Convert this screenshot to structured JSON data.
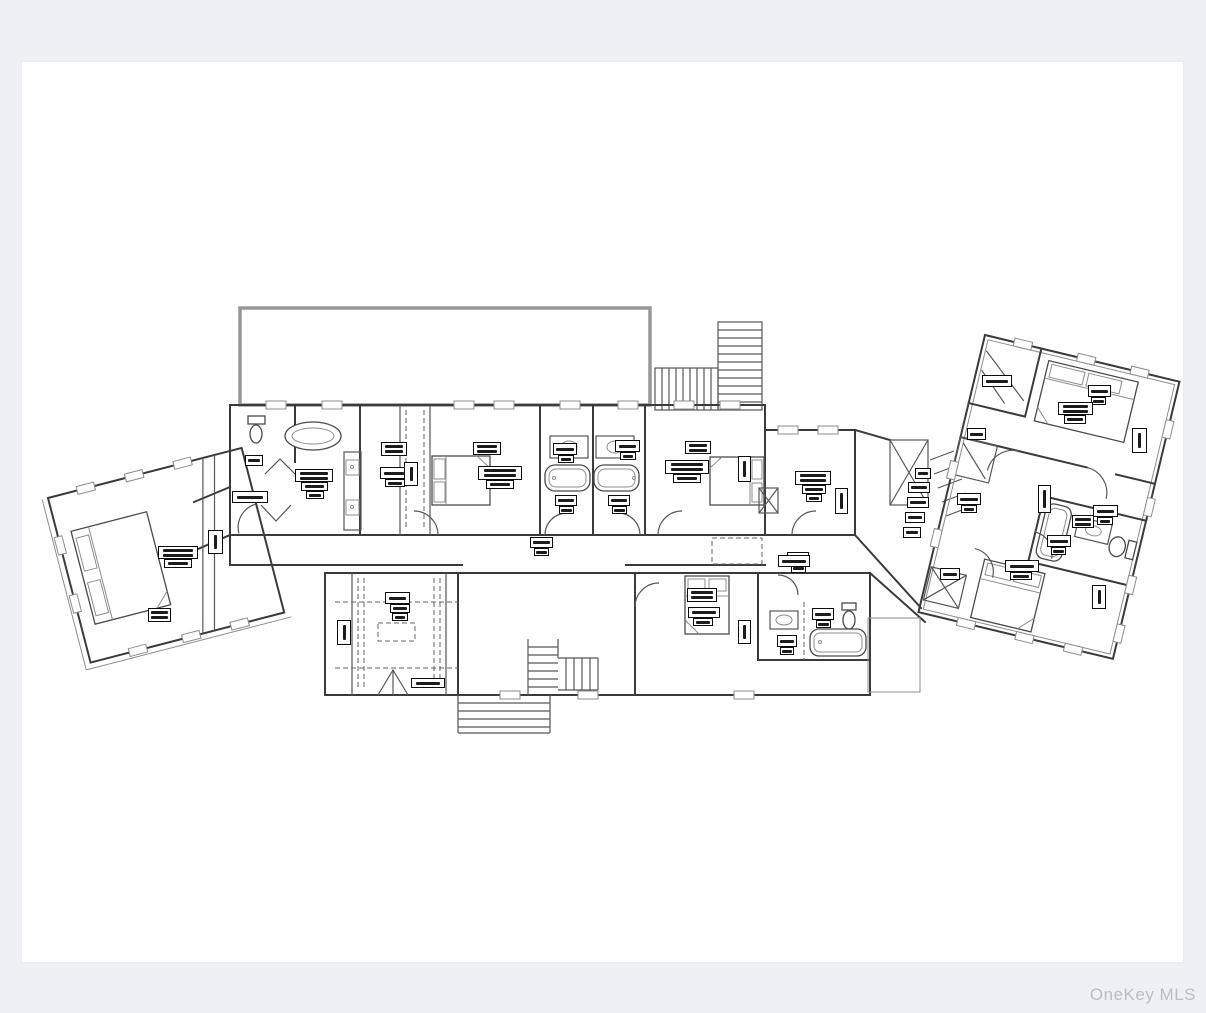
{
  "page": {
    "background_color": "#eff0f5",
    "panel_color": "#ffffff"
  },
  "watermark": {
    "text": "OneKey MLS",
    "color": "#b9bdc5"
  },
  "floorplan": {
    "type": "architectural-floor-plan",
    "content_note": "Black-and-white residential floor plan line drawing on a white sheet: a long central body with bathrooms and bedrooms, an angled bedroom wing on the left, an angled multi-room wing on the right, a large deck outline at top, interior and exterior staircases, beds, tubs, toilets and vanities drawn in plan view.",
    "label_legibility": "Room name and dimension labels are present as small boxed annotations but are illegible at source resolution",
    "labels": [
      [
        223,
        393,
        18,
        11
      ],
      [
        210,
        429,
        36,
        12
      ],
      [
        273,
        407,
        38,
        13
      ],
      [
        279,
        420,
        27,
        9
      ],
      [
        284,
        429,
        18,
        8
      ],
      [
        359,
        380,
        26,
        14
      ],
      [
        358,
        405,
        28,
        12
      ],
      [
        363,
        417,
        20,
        8
      ],
      [
        382,
        400,
        14,
        24
      ],
      [
        451,
        380,
        28,
        13
      ],
      [
        456,
        404,
        44,
        14
      ],
      [
        464,
        418,
        28,
        9
      ],
      [
        531,
        381,
        24,
        12
      ],
      [
        536,
        393,
        16,
        8
      ],
      [
        593,
        378,
        25,
        12
      ],
      [
        598,
        390,
        16,
        8
      ],
      [
        533,
        433,
        22,
        11
      ],
      [
        537,
        444,
        15,
        8
      ],
      [
        586,
        433,
        22,
        11
      ],
      [
        590,
        444,
        15,
        8
      ],
      [
        508,
        475,
        23,
        11
      ],
      [
        512,
        486,
        15,
        8
      ],
      [
        663,
        379,
        26,
        13
      ],
      [
        643,
        398,
        44,
        14
      ],
      [
        651,
        412,
        28,
        9
      ],
      [
        716,
        394,
        13,
        26
      ],
      [
        773,
        409,
        36,
        14
      ],
      [
        780,
        423,
        24,
        9
      ],
      [
        784,
        432,
        16,
        8
      ],
      [
        813,
        426,
        13,
        26
      ],
      [
        893,
        406,
        16,
        11
      ],
      [
        886,
        420,
        22,
        11
      ],
      [
        885,
        435,
        22,
        11
      ],
      [
        883,
        450,
        20,
        11
      ],
      [
        881,
        465,
        18,
        11
      ],
      [
        765,
        490,
        22,
        12
      ],
      [
        769,
        502,
        15,
        9
      ],
      [
        363,
        530,
        25,
        12
      ],
      [
        368,
        542,
        20,
        9
      ],
      [
        370,
        551,
        16,
        8
      ],
      [
        315,
        558,
        14,
        25
      ],
      [
        389,
        616,
        34,
        10
      ],
      [
        665,
        526,
        30,
        14
      ],
      [
        666,
        545,
        32,
        11
      ],
      [
        671,
        556,
        20,
        8
      ],
      [
        716,
        558,
        13,
        24
      ],
      [
        756,
        493,
        32,
        12
      ],
      [
        790,
        546,
        22,
        12
      ],
      [
        794,
        558,
        15,
        8
      ],
      [
        755,
        573,
        20,
        12
      ],
      [
        758,
        585,
        14,
        8
      ],
      [
        136,
        484,
        40,
        13
      ],
      [
        142,
        497,
        28,
        9
      ],
      [
        186,
        468,
        15,
        24
      ],
      [
        126,
        546,
        23,
        14
      ],
      [
        960,
        313,
        30,
        12
      ],
      [
        945,
        366,
        19,
        12
      ],
      [
        1066,
        323,
        23,
        12
      ],
      [
        1069,
        335,
        15,
        8
      ],
      [
        1036,
        340,
        35,
        13
      ],
      [
        1042,
        353,
        22,
        9
      ],
      [
        1110,
        366,
        15,
        25
      ],
      [
        935,
        431,
        24,
        12
      ],
      [
        939,
        443,
        16,
        8
      ],
      [
        1016,
        423,
        13,
        28
      ],
      [
        1071,
        443,
        25,
        12
      ],
      [
        1075,
        455,
        16,
        8
      ],
      [
        1050,
        453,
        22,
        13
      ],
      [
        1025,
        473,
        24,
        12
      ],
      [
        1029,
        485,
        15,
        8
      ],
      [
        918,
        506,
        20,
        12
      ],
      [
        983,
        498,
        34,
        12
      ],
      [
        988,
        510,
        22,
        8
      ],
      [
        1070,
        523,
        14,
        24
      ]
    ]
  }
}
